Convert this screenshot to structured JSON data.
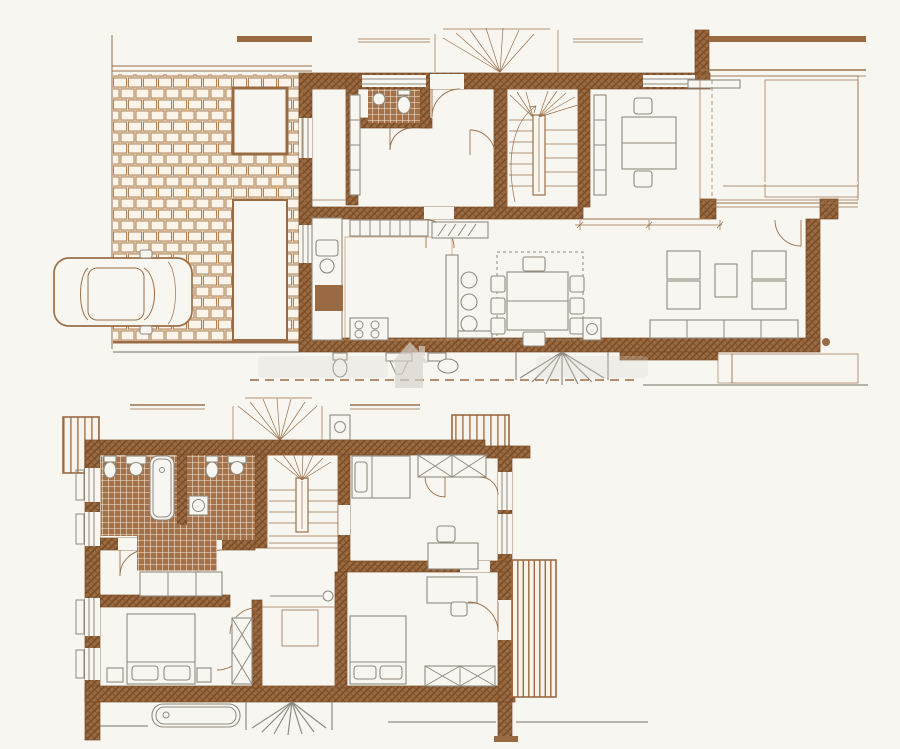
{
  "document": {
    "kind": "architectural floor plan drawing",
    "sheets": [
      "ground-floor-plan",
      "upper-floor-plan"
    ],
    "visible_text": ""
  },
  "colors": {
    "paper": "#f8f6f1",
    "wallFill": "#9a6a42",
    "wallDark": "#7a4c26",
    "ink": "#9b7049",
    "tileLine": "#bf9468",
    "tileFill": "#faf6ee",
    "mosaic": "#a3714a",
    "mosaicLine": "#f3e9dc",
    "pavBrick": "#faf4ea",
    "pavGrout": "#e9dcc8",
    "pavLine": "#b08255",
    "deckFill": "#f8f4ec",
    "deckLine": "#9a6a42",
    "furn": "#8f8b80",
    "wmk": "#d7d3cb"
  },
  "watermark": {
    "icon": "house",
    "text_legible": false,
    "opacity": 0.32
  },
  "plans": {
    "ground_floor": {
      "name": "ground floor",
      "features": [
        "site-boundary",
        "paved-driveway",
        "car",
        "planter-beds",
        "porch",
        "wc",
        "hall",
        "winder-staircase",
        "study",
        "kitchen",
        "dining-area",
        "living-area",
        "roof-deck-terrace",
        "lower-terrace-strip",
        "neighbor-unit-cutoff",
        "dimension-line"
      ]
    },
    "upper_floor": {
      "name": "upper floor",
      "features": [
        "balcony-left",
        "balcony-right",
        "bathroom-1",
        "bathroom-2",
        "winder-staircase",
        "dressing-tiles",
        "bedroom-left",
        "bedroom-top-right",
        "bedroom-bottom-right",
        "dotted-floor-room",
        "wardrobes",
        "neighbor-unit-cutoff"
      ]
    }
  }
}
